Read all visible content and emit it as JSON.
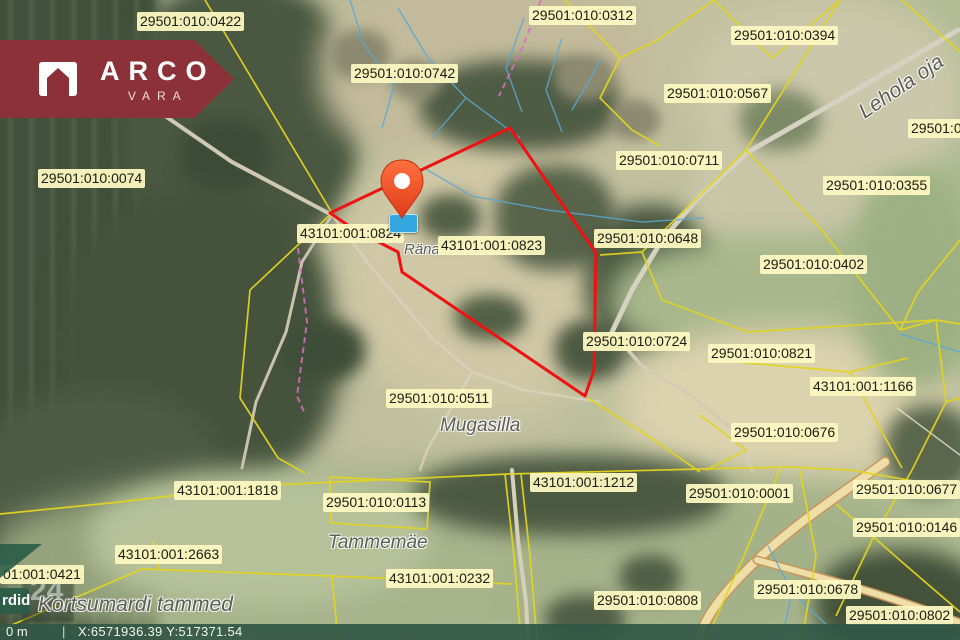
{
  "logo": {
    "title": "ARCO",
    "subtitle": "VARA"
  },
  "statusbar": {
    "scale_label": "0 m",
    "separator": "|",
    "coordinates": "X:6571936.39 Y:517371.54"
  },
  "side_panel": {
    "cut_button_label": "rdid",
    "grid_number": "24"
  },
  "colors": {
    "parcel_line": "#e3d41f",
    "highlight_line": "#ee1212",
    "label_bg": "#fcf8c1",
    "logo_bg": "#8d3138",
    "water_line": "#5aa8d6",
    "trail_line": "#d86fc3",
    "pin_orange": "#f4502a",
    "marker_blue": "#35a7e0",
    "statusbar_bg": "#325646"
  },
  "map": {
    "parcel_labels": [
      {
        "text": "29501:010:0422",
        "x": 137,
        "y": 12
      },
      {
        "text": "29501:010:0312",
        "x": 529,
        "y": 6
      },
      {
        "text": "29501:010:0394",
        "x": 731,
        "y": 26
      },
      {
        "text": "29501:010:0742",
        "x": 351,
        "y": 64
      },
      {
        "text": "29501:010:0567",
        "x": 664,
        "y": 84
      },
      {
        "text": "29501:0",
        "x": 908,
        "y": 119
      },
      {
        "text": "29501:010:0711",
        "x": 616,
        "y": 151
      },
      {
        "text": "29501:010:0355",
        "x": 823,
        "y": 176
      },
      {
        "text": "29501:010:0074",
        "x": 38,
        "y": 169
      },
      {
        "text": "43101:001:0824",
        "x": 297,
        "y": 224
      },
      {
        "text": "43101:001:0823",
        "x": 438,
        "y": 236
      },
      {
        "text": "29501:010:0648",
        "x": 594,
        "y": 229
      },
      {
        "text": "29501:010:0402",
        "x": 760,
        "y": 255
      },
      {
        "text": "29501:010:0724",
        "x": 583,
        "y": 332
      },
      {
        "text": "29501:010:0821",
        "x": 708,
        "y": 344
      },
      {
        "text": "43101:001:1166",
        "x": 810,
        "y": 377
      },
      {
        "text": "29501:010:0511",
        "x": 386,
        "y": 389
      },
      {
        "text": "29501:010:0676",
        "x": 731,
        "y": 423
      },
      {
        "text": "43101:001:1818",
        "x": 174,
        "y": 481
      },
      {
        "text": "43101:001:1212",
        "x": 530,
        "y": 473
      },
      {
        "text": "29501:010:0001",
        "x": 686,
        "y": 484
      },
      {
        "text": "29501:010:0677",
        "x": 853,
        "y": 480
      },
      {
        "text": "29501:010:0113",
        "x": 323,
        "y": 493
      },
      {
        "text": "29501:010:0146",
        "x": 853,
        "y": 518
      },
      {
        "text": "43101:001:2663",
        "x": 115,
        "y": 545
      },
      {
        "text": "01:001:0421",
        "x": 0,
        "y": 565
      },
      {
        "text": "43101:001:0232",
        "x": 386,
        "y": 569
      },
      {
        "text": "29501:010:0808",
        "x": 594,
        "y": 591
      },
      {
        "text": "29501:010:0678",
        "x": 754,
        "y": 580
      },
      {
        "text": "29501:010:0802",
        "x": 846,
        "y": 606
      }
    ],
    "place_names": [
      {
        "text": "Lehola oja",
        "x": 868,
        "y": 100,
        "size": 21,
        "rotate": -34
      },
      {
        "text": "Ränandsova",
        "x": 404,
        "y": 241,
        "size": 15
      },
      {
        "text": "Mugasilla",
        "x": 440,
        "y": 415,
        "size": 19
      },
      {
        "text": "Tammemäe",
        "x": 328,
        "y": 532,
        "size": 19
      },
      {
        "text": "Kortsumardi tammed",
        "x": 38,
        "y": 593,
        "size": 21
      }
    ]
  }
}
